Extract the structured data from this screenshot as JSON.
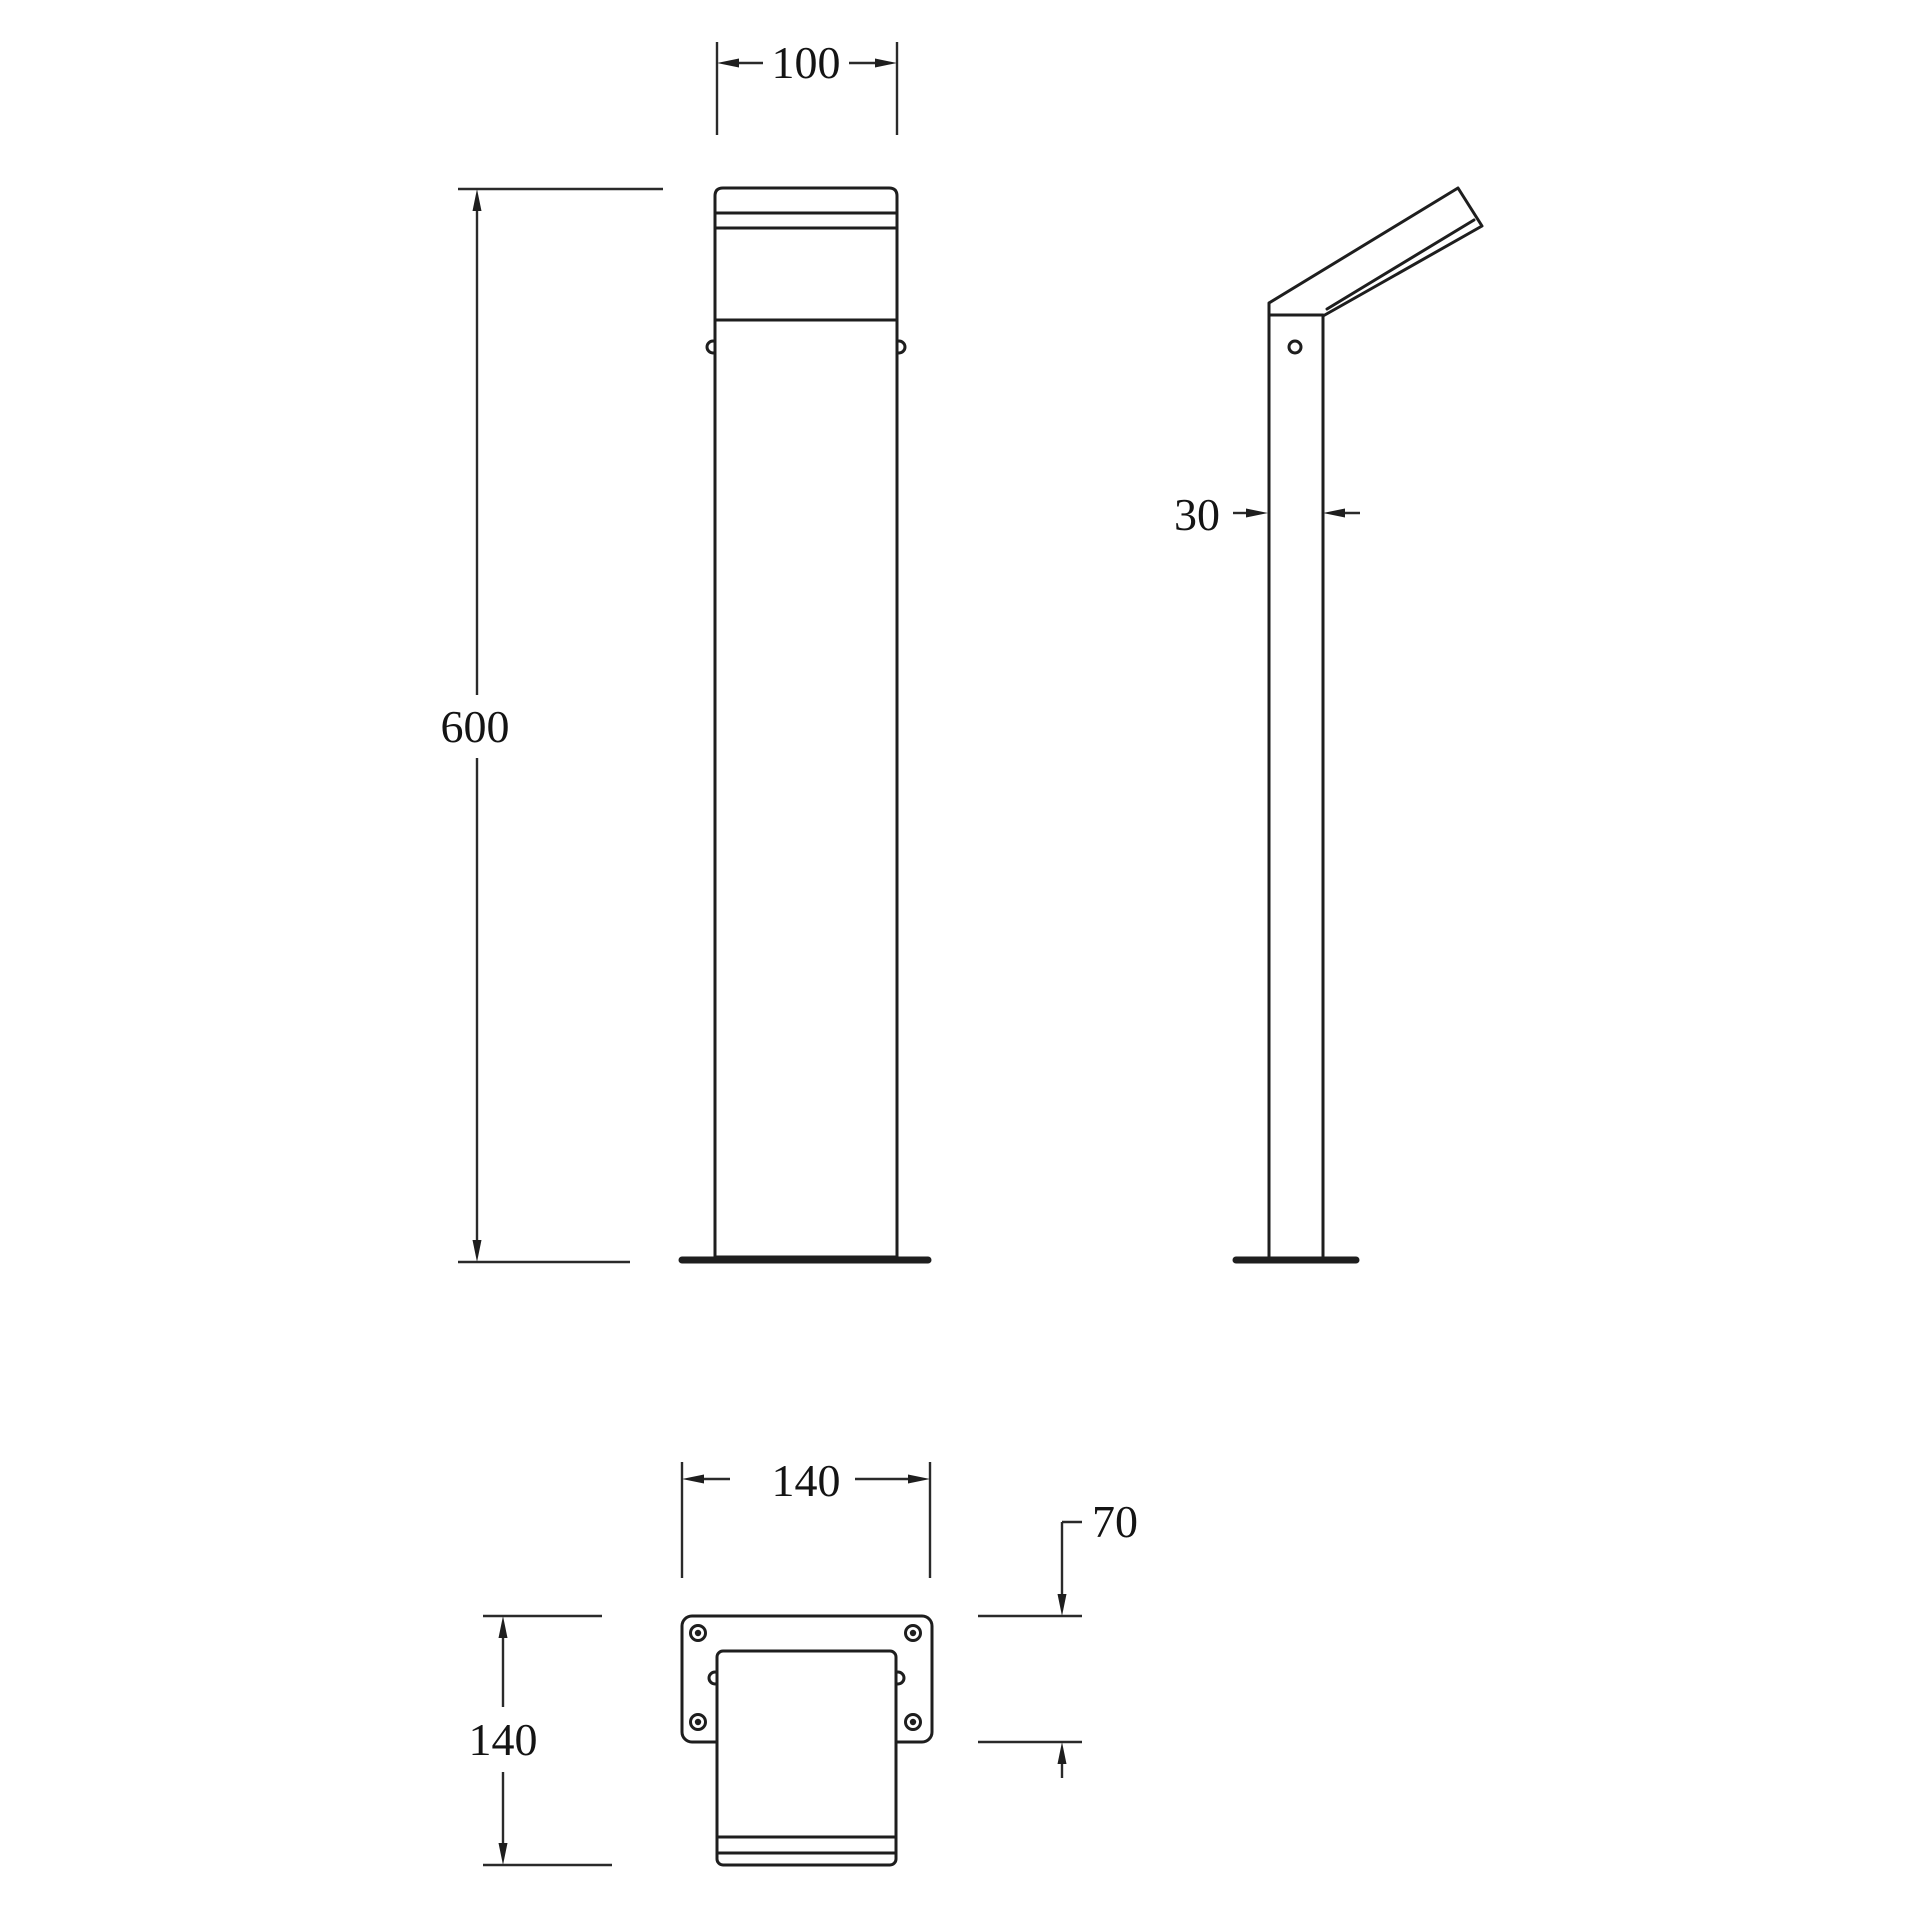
{
  "drawing": {
    "kind": "technical-dimension-drawing",
    "units": "mm",
    "colors": {
      "line": "#1e1e1e",
      "background": "#ffffff",
      "text": "#141414"
    },
    "views": {
      "front": {
        "name": "front view",
        "width_label": "100",
        "height_label": "600"
      },
      "side": {
        "name": "side view",
        "depth_label": "30"
      },
      "bottom": {
        "name": "bottom view (base plate)",
        "plate_width_label": "140",
        "plate_height_label": "140",
        "plate_offset_label": "70"
      }
    }
  }
}
